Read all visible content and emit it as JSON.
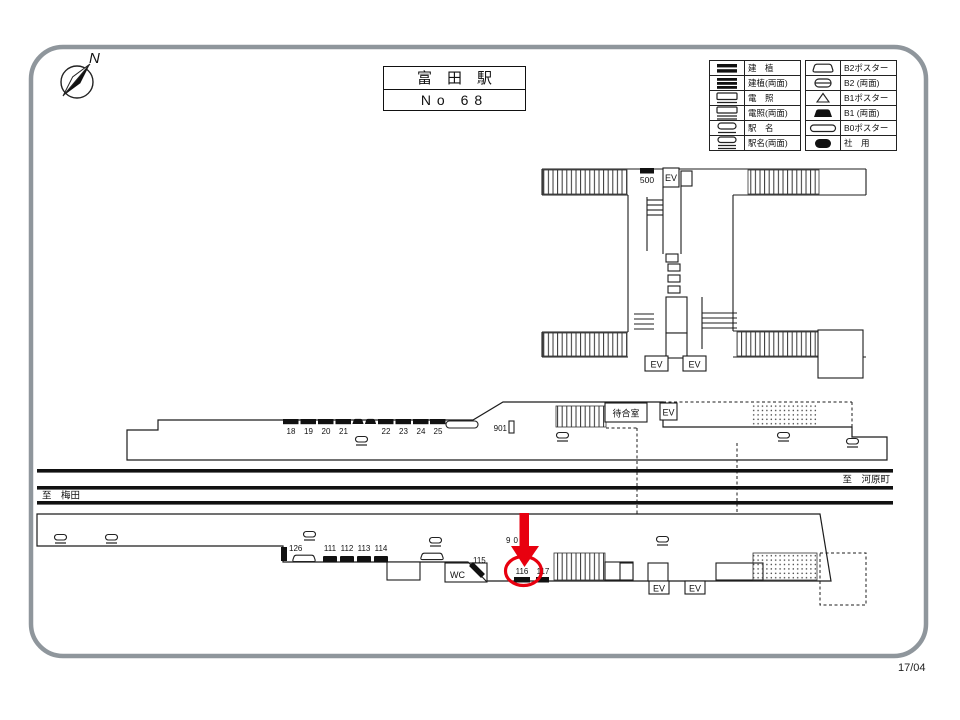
{
  "page": {
    "date_code": "17/04"
  },
  "compass": {
    "label": "N"
  },
  "title_box": {
    "station_name": "富　田　駅",
    "number": "No 68"
  },
  "legend": {
    "left": [
      {
        "icon": "kenchiku-icon",
        "label": "建　植"
      },
      {
        "icon": "kenchiku-double-icon",
        "label": "建植(両面)"
      },
      {
        "icon": "densho-icon",
        "label": "電　照"
      },
      {
        "icon": "densho-double-icon",
        "label": "電照(両面)"
      },
      {
        "icon": "ekimei-icon",
        "label": "駅　名"
      },
      {
        "icon": "ekimei-double-icon",
        "label": "駅名(両面)"
      }
    ],
    "right": [
      {
        "icon": "b2-poster-icon",
        "label": "B2ポスター"
      },
      {
        "icon": "b2-double-icon",
        "label": "B2 (両面)"
      },
      {
        "icon": "b1-poster-icon",
        "label": "B1ポスター"
      },
      {
        "icon": "b1-double-icon",
        "label": "B1 (両面)"
      },
      {
        "icon": "b0-poster-icon",
        "label": "B0ポスター"
      },
      {
        "icon": "company-use-icon",
        "label": "社　用",
        "badge": "NO"
      }
    ]
  },
  "map": {
    "labels": {
      "ev": "EV",
      "waiting_room": "待合室",
      "wc": "WC",
      "to_left": "至　梅田",
      "to_right": "至　河原町"
    },
    "upper_markers": {
      "m18": "18",
      "m19": "19",
      "m20": "20",
      "m21": "21",
      "m22": "22",
      "m23": "23",
      "m24": "24",
      "m25": "25",
      "m500": "500",
      "m901": "901"
    },
    "lower_markers": {
      "m126": "126",
      "m111": "111",
      "m112": "112",
      "m113": "113",
      "m114": "114",
      "m115": "115",
      "m902": "902",
      "m116": "116",
      "m117": "117"
    },
    "highlight": {
      "circled_marker": "116"
    }
  },
  "colors": {
    "highlight_red": "#e8000f",
    "line": "#1c1c1c",
    "border_gray": "#8f969c"
  }
}
